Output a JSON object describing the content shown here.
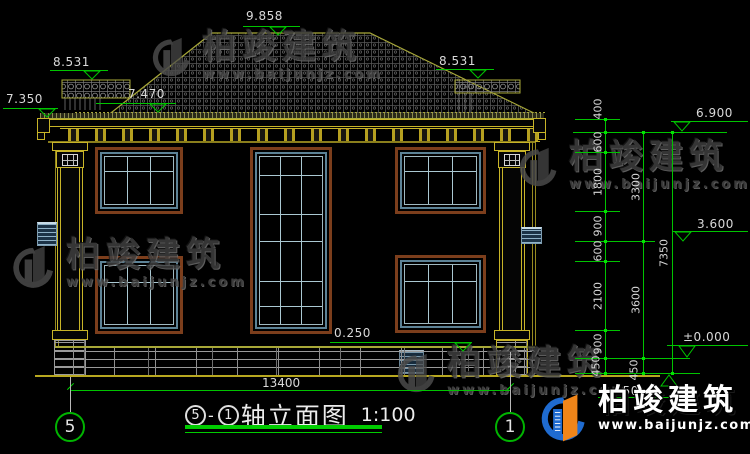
{
  "watermark": {
    "name": "柏竣建筑",
    "url": "www.baijunjz.com"
  },
  "brand": {
    "name": "柏竣建筑",
    "url": "www.baijunjz.com"
  },
  "levels": {
    "ridge": "9.858",
    "wing_left": "8.531",
    "wing_right": "8.531",
    "eave": "7.350",
    "slope": "7.470",
    "plinth": "0.250",
    "upper": "6.900",
    "mid": "3.600",
    "zero": "±0.000",
    "below": "0.450"
  },
  "dims": {
    "total_width": "13400",
    "chain1": [
      "400",
      "600",
      "1800",
      "900",
      "600",
      "2100",
      "900",
      "450"
    ],
    "chain2": [
      "3300",
      "3600",
      "450"
    ],
    "chain3": [
      "7350"
    ]
  },
  "axes": {
    "left": "5",
    "right": "1"
  },
  "title": {
    "axis_from": "5",
    "separator": "-",
    "axis_to": "1",
    "text": "轴立面图",
    "scale": "1:100"
  },
  "colors": {
    "dim_green": "#00c400",
    "cornice_yellow": "#c8b428",
    "frame_brown": "#7c3e1c",
    "sash_blue": "#5c8296"
  }
}
